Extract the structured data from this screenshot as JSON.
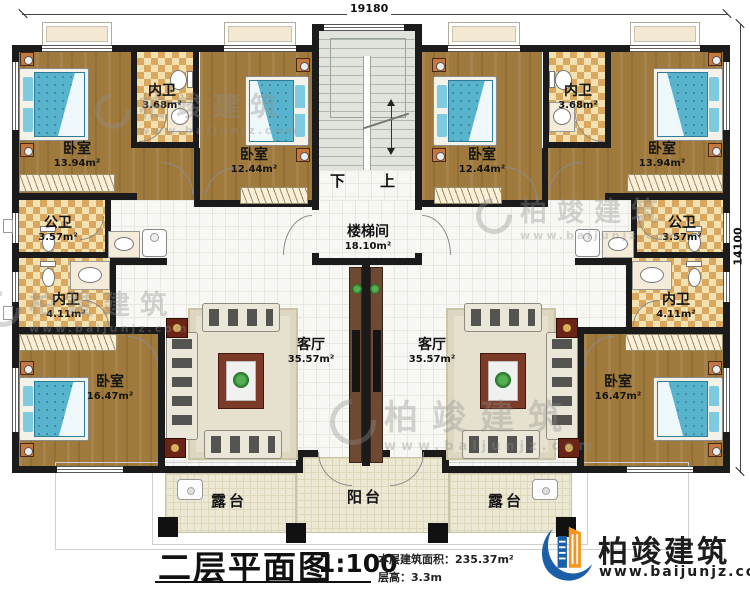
{
  "plan": {
    "dimensions": {
      "top": "19180",
      "right": "14100"
    },
    "stairs": {
      "down": "下",
      "up": "上"
    },
    "rooms": {
      "bedroom_top_left": {
        "name": "卧室",
        "area": "13.94m²"
      },
      "bath_ensuite_top_left": {
        "name": "内卫",
        "area": "3.68m²"
      },
      "bedroom_mid_left": {
        "name": "卧室",
        "area": "12.44m²"
      },
      "stair_hall": {
        "name": "楼梯间",
        "area": "18.10m²"
      },
      "bath_shared_left": {
        "name": "公卫",
        "area": "3.57m²"
      },
      "bath_ensuite_left": {
        "name": "内卫",
        "area": "4.11m²"
      },
      "bedroom_bottom_left": {
        "name": "卧室",
        "area": "16.47m²"
      },
      "living_left": {
        "name": "客厅",
        "area": "35.57m²"
      },
      "living_right": {
        "name": "客厅",
        "area": "35.57m²"
      },
      "bedroom_mid_right": {
        "name": "卧室",
        "area": "12.44m²"
      },
      "bath_ensuite_top_right": {
        "name": "内卫",
        "area": "3.68m²"
      },
      "bedroom_top_right": {
        "name": "卧室",
        "area": "13.94m²"
      },
      "bath_shared_right": {
        "name": "公卫",
        "area": "3.57m²"
      },
      "bath_ensuite_right": {
        "name": "内卫",
        "area": "4.11m²"
      },
      "bedroom_bottom_right": {
        "name": "卧室",
        "area": "16.47m²"
      },
      "terrace_left": {
        "name": "露台"
      },
      "balcony": {
        "name": "阳台"
      },
      "terrace_right": {
        "name": "露台"
      }
    }
  },
  "title_block": {
    "title": "二层平面图",
    "scale": "1:100",
    "area_line": "本层建筑面积：235.37m²",
    "height_line": "层高：3.3m"
  },
  "branding": {
    "name": "柏竣建筑",
    "website": "www.baijunjz.com"
  },
  "watermark": {
    "text": "柏竣建筑",
    "website": "www.baijunjz.com"
  },
  "colors": {
    "wall": "#1b1b1b",
    "wood_floor": "#a07a3c",
    "bath_tile": "#e9cf96",
    "bed": "#58b4cd",
    "stair": "#dfe3da",
    "terrace": "#ece8d4",
    "logo_blue": "#1a5fa8",
    "logo_orange": "#f7941e"
  }
}
